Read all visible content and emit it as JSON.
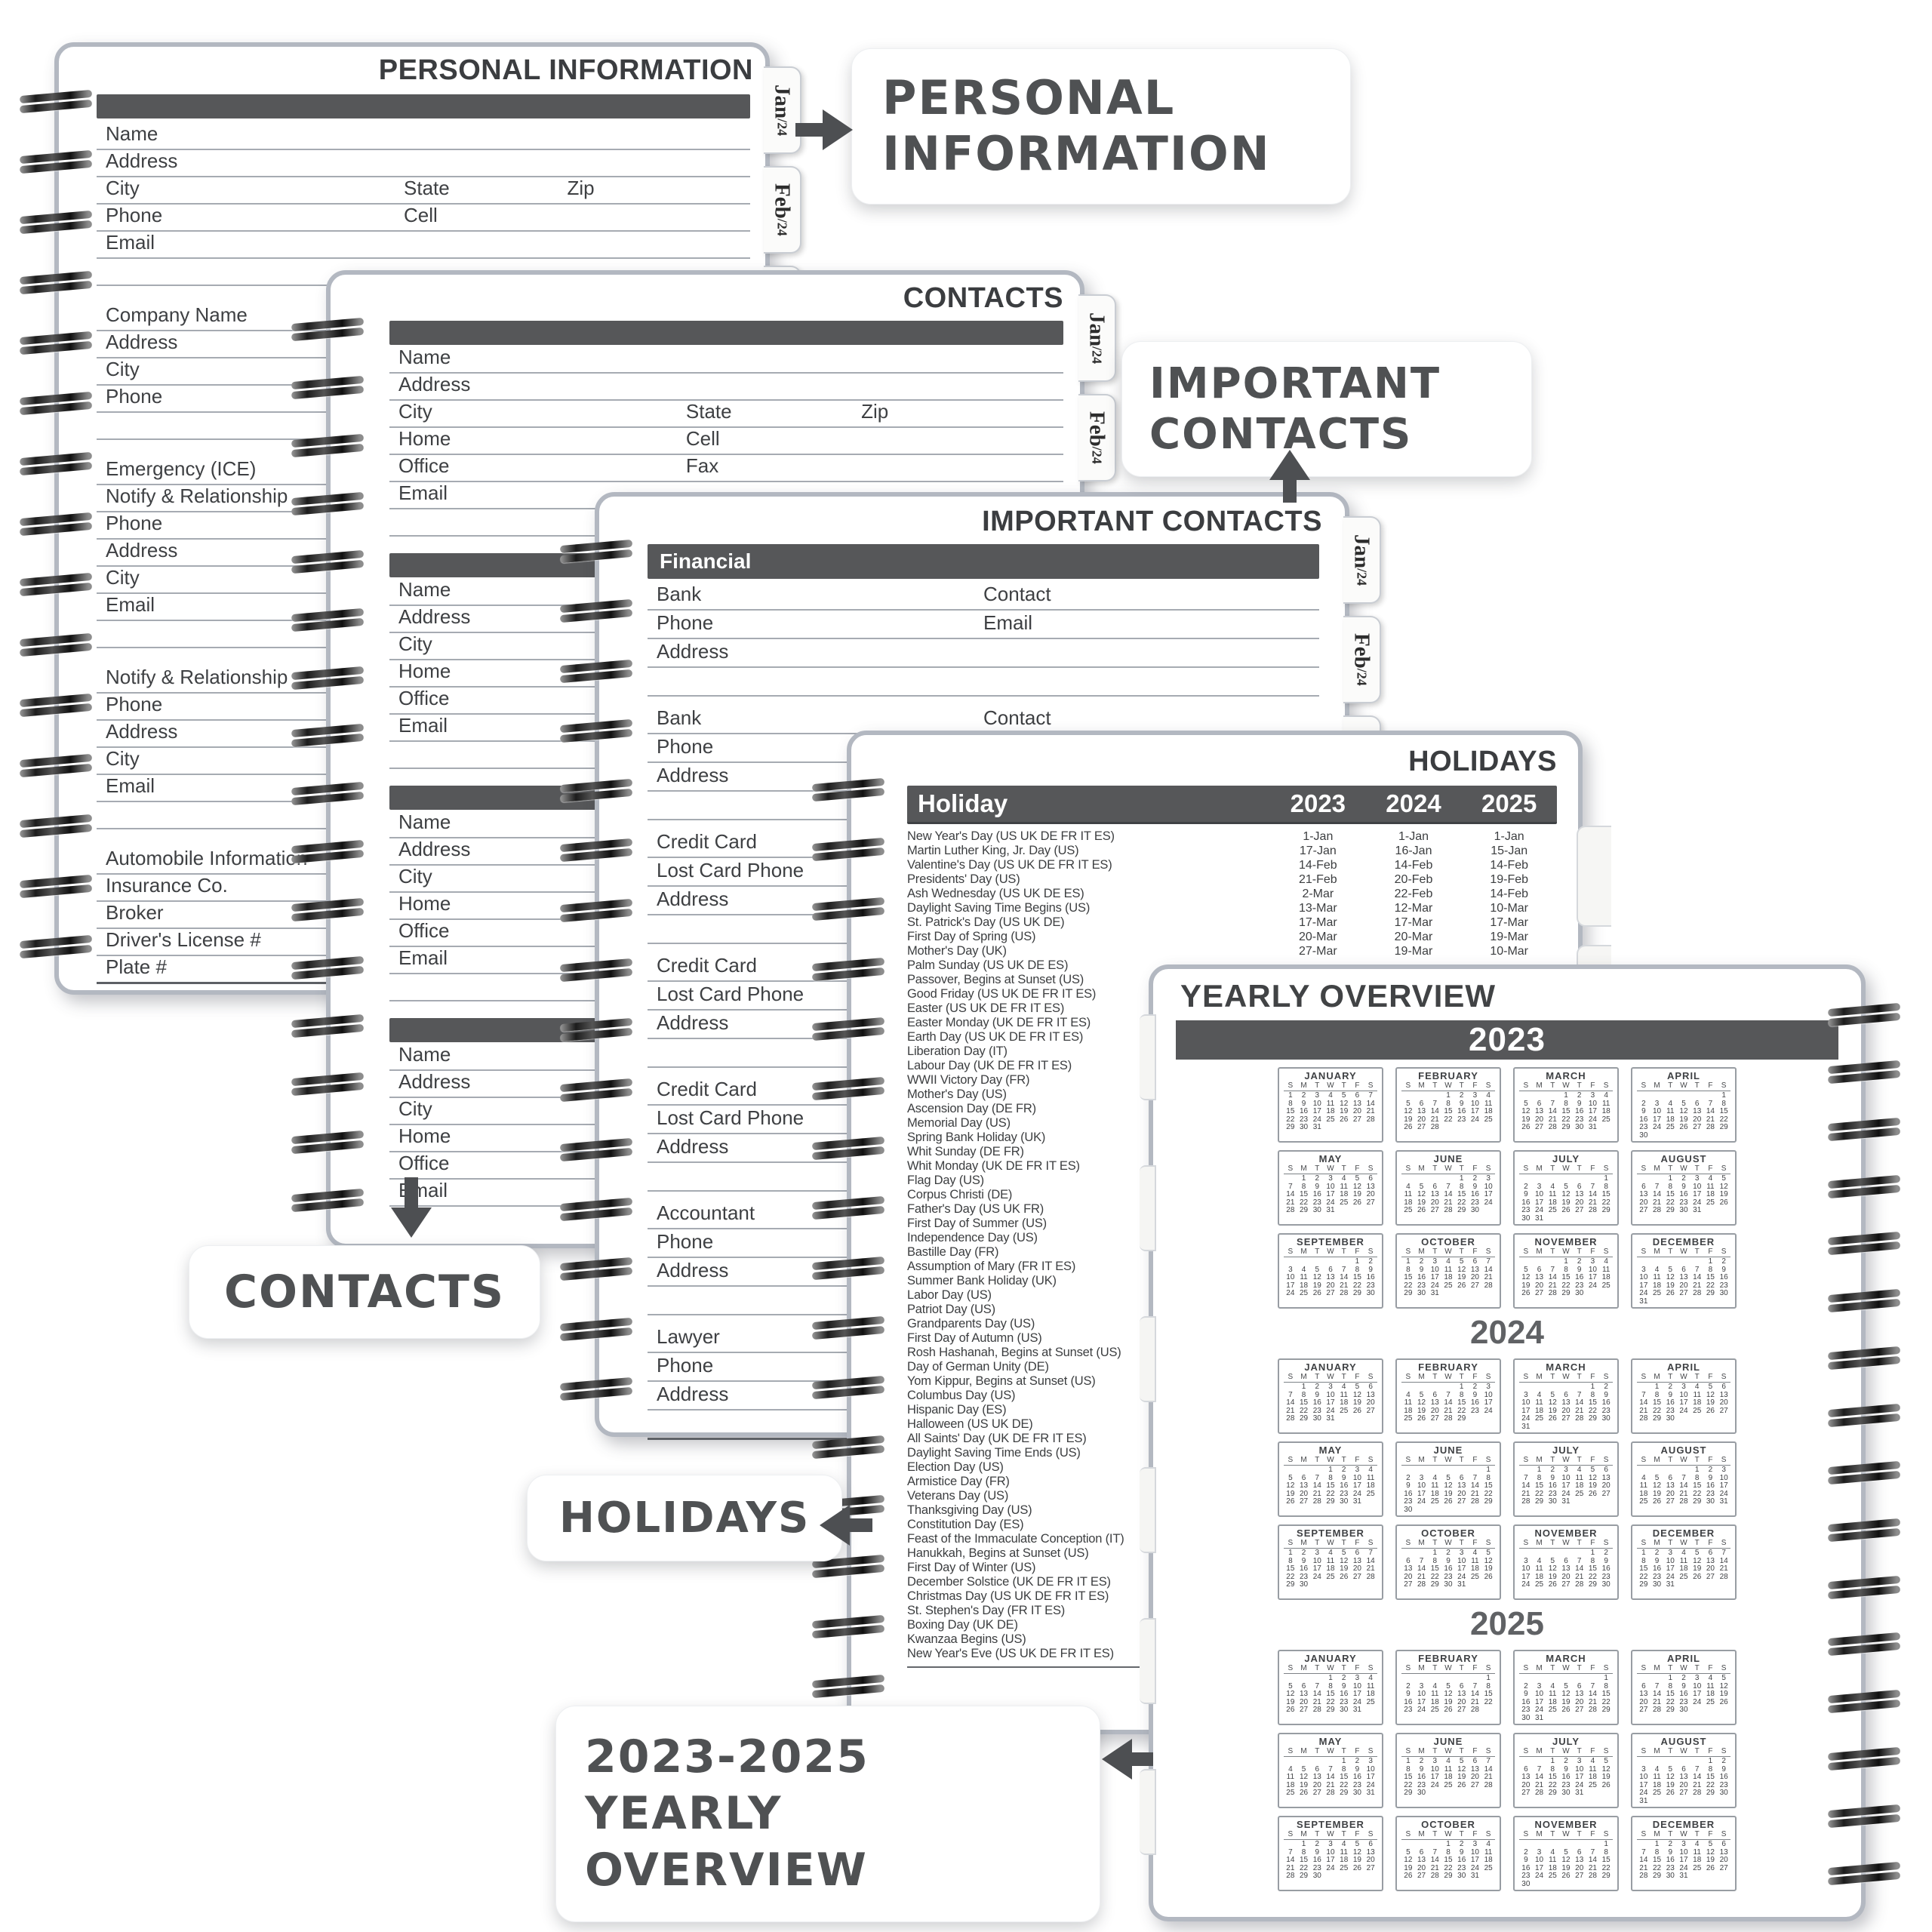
{
  "colors": {
    "bar": "#565759",
    "ink": "#3e4043",
    "line": "#a6abb2",
    "callout_text": "#4f5153",
    "arrow": "#4d4f52",
    "page_border": "#b3b8c1"
  },
  "callouts": {
    "personal": "PERSONAL INFORMATION",
    "important": "IMPORTANT CONTACTS",
    "contacts": "CONTACTS",
    "holidays": "HOLIDAYS",
    "yearly": "2023-2025 YEARLY OVERVIEW"
  },
  "tabs": {
    "items": [
      {
        "label": "Jan",
        "suffix": "/24"
      },
      {
        "label": "Feb",
        "suffix": "/24"
      },
      {
        "label": "Ma",
        "suffix": ""
      }
    ]
  },
  "pages": {
    "personal": {
      "title": "PERSONAL INFORMATION",
      "sections": [
        {
          "bar": true,
          "rows": [
            [
              "Name"
            ],
            [
              "Address"
            ],
            [
              "City",
              "State",
              "Zip"
            ],
            [
              "Phone",
              "Cell"
            ],
            [
              "Email"
            ],
            []
          ]
        },
        {
          "rows": [
            [
              "Company Name"
            ],
            [
              "Address"
            ],
            [
              "City"
            ],
            [
              "Phone"
            ],
            []
          ]
        },
        {
          "rows": [
            [
              "Emergency (ICE)"
            ],
            [
              "Notify & Relationship"
            ],
            [
              "Phone"
            ],
            [
              "Address"
            ],
            [
              "City"
            ],
            [
              "Email"
            ],
            []
          ]
        },
        {
          "rows": [
            [
              "Notify & Relationship"
            ],
            [
              "Phone"
            ],
            [
              "Address"
            ],
            [
              "City"
            ],
            [
              "Email"
            ],
            []
          ]
        },
        {
          "rows": [
            [
              "Automobile Information"
            ],
            [
              "Insurance Co."
            ],
            [
              "Broker"
            ],
            [
              "Driver's License #"
            ],
            [
              "Plate #"
            ]
          ]
        }
      ]
    },
    "contacts": {
      "title": "CONTACTS",
      "sections": [
        {
          "bar": true,
          "rows": [
            [
              "Name"
            ],
            [
              "Address"
            ],
            [
              "City",
              "State",
              "Zip"
            ],
            [
              "Home",
              "Cell"
            ],
            [
              "Office",
              "Fax"
            ],
            [
              "Email"
            ],
            []
          ]
        },
        {
          "bar": true,
          "rows": [
            [
              "Name"
            ],
            [
              "Address"
            ],
            [
              "City"
            ],
            [
              "Home"
            ],
            [
              "Office"
            ],
            [
              "Email"
            ],
            []
          ]
        },
        {
          "bar": true,
          "rows": [
            [
              "Name"
            ],
            [
              "Address"
            ],
            [
              "City"
            ],
            [
              "Home"
            ],
            [
              "Office"
            ],
            [
              "Email"
            ],
            []
          ]
        },
        {
          "bar": true,
          "rows": [
            [
              "Name"
            ],
            [
              "Address"
            ],
            [
              "City"
            ],
            [
              "Home"
            ],
            [
              "Office"
            ],
            [
              "Email"
            ]
          ]
        }
      ]
    },
    "important": {
      "title": "IMPORTANT CONTACTS",
      "sections": [
        {
          "bar": true,
          "bar_label": "Financial",
          "rows": [
            [
              "Bank",
              "Contact"
            ],
            [
              "Phone",
              "Email"
            ],
            [
              "Address"
            ],
            []
          ]
        },
        {
          "rows": [
            [
              "Bank",
              "Contact"
            ],
            [
              "Phone",
              "Email"
            ],
            [
              "Address"
            ],
            []
          ]
        },
        {
          "rows": [
            [
              "Credit Card"
            ],
            [
              "Lost Card Phone"
            ],
            [
              "Address"
            ],
            []
          ]
        },
        {
          "rows": [
            [
              "Credit Card"
            ],
            [
              "Lost Card Phone"
            ],
            [
              "Address"
            ],
            []
          ]
        },
        {
          "rows": [
            [
              "Credit Card"
            ],
            [
              "Lost Card Phone"
            ],
            [
              "Address"
            ],
            []
          ]
        },
        {
          "rows": [
            [
              "Accountant"
            ],
            [
              "Phone"
            ],
            [
              "Address"
            ],
            []
          ]
        },
        {
          "rows": [
            [
              "Lawyer"
            ],
            [
              "Phone"
            ],
            [
              "Address"
            ],
            []
          ]
        }
      ]
    },
    "holidays": {
      "title": "HOLIDAYS",
      "header": {
        "holiday": "Holiday",
        "years": [
          "2023",
          "2024",
          "2025"
        ]
      },
      "rows": [
        {
          "name": "New Year's Day (US UK DE FR IT ES)",
          "dates": [
            "1-Jan",
            "1-Jan",
            "1-Jan"
          ]
        },
        {
          "name": "Martin Luther King, Jr. Day (US)",
          "dates": [
            "17-Jan",
            "16-Jan",
            "15-Jan"
          ]
        },
        {
          "name": "Valentine's Day (US UK DE FR IT ES)",
          "dates": [
            "14-Feb",
            "14-Feb",
            "14-Feb"
          ]
        },
        {
          "name": "Presidents' Day (US)",
          "dates": [
            "21-Feb",
            "20-Feb",
            "19-Feb"
          ]
        },
        {
          "name": "Ash Wednesday (US UK DE ES)",
          "dates": [
            "2-Mar",
            "22-Feb",
            "14-Feb"
          ]
        },
        {
          "name": "Daylight Saving Time Begins (US)",
          "dates": [
            "13-Mar",
            "12-Mar",
            "10-Mar"
          ]
        },
        {
          "name": "St. Patrick's Day (US UK DE)",
          "dates": [
            "17-Mar",
            "17-Mar",
            "17-Mar"
          ]
        },
        {
          "name": "First Day of Spring (US)",
          "dates": [
            "20-Mar",
            "20-Mar",
            "19-Mar"
          ]
        },
        {
          "name": "Mother's Day (UK)",
          "dates": [
            "27-Mar",
            "19-Mar",
            "10-Mar"
          ]
        },
        {
          "name": "Palm Sunday (US UK DE ES)"
        },
        {
          "name": "Passover, Begins at Sunset (US)"
        },
        {
          "name": "Good Friday (US UK DE FR IT ES)"
        },
        {
          "name": "Easter (US UK DE FR IT ES)"
        },
        {
          "name": "Easter Monday (UK DE FR IT ES)"
        },
        {
          "name": "Earth Day (US UK DE FR IT ES)"
        },
        {
          "name": "Liberation Day (IT)"
        },
        {
          "name": "Labour Day (UK DE FR IT ES)"
        },
        {
          "name": "WWII Victory Day (FR)"
        },
        {
          "name": "Mother's Day (US)"
        },
        {
          "name": "Ascension Day (DE FR)"
        },
        {
          "name": "Memorial Day (US)"
        },
        {
          "name": "Spring Bank Holiday (UK)"
        },
        {
          "name": "Whit Sunday (DE FR)"
        },
        {
          "name": "Whit Monday (UK DE FR IT ES)"
        },
        {
          "name": "Flag Day (US)"
        },
        {
          "name": "Corpus Christi (DE)"
        },
        {
          "name": "Father's Day (US UK FR)"
        },
        {
          "name": "First Day of Summer (US)"
        },
        {
          "name": "Independence Day (US)"
        },
        {
          "name": "Bastille Day (FR)"
        },
        {
          "name": "Assumption of Mary (FR IT ES)"
        },
        {
          "name": "Summer Bank Holiday (UK)"
        },
        {
          "name": "Labor Day (US)"
        },
        {
          "name": "Patriot Day (US)"
        },
        {
          "name": "Grandparents Day (US)"
        },
        {
          "name": "First Day of Autumn (US)"
        },
        {
          "name": "Rosh Hashanah, Begins at Sunset (US)"
        },
        {
          "name": "Day of German Unity (DE)"
        },
        {
          "name": "Yom Kippur, Begins at Sunset (US)"
        },
        {
          "name": "Columbus Day (US)"
        },
        {
          "name": "Hispanic Day (ES)"
        },
        {
          "name": "Halloween (US UK DE)"
        },
        {
          "name": "All Saints' Day (UK DE FR IT ES)"
        },
        {
          "name": "Daylight Saving Time Ends (US)"
        },
        {
          "name": "Election Day (US)"
        },
        {
          "name": "Armistice Day (FR)"
        },
        {
          "name": "Veterans Day (US)"
        },
        {
          "name": "Thanksgiving Day (US)"
        },
        {
          "name": "Constitution Day (ES)"
        },
        {
          "name": "Feast of the Immaculate Conception (IT)"
        },
        {
          "name": "Hanukkah, Begins at Sunset (US)"
        },
        {
          "name": "First Day of Winter (US)"
        },
        {
          "name": "December Solstice (UK DE FR IT ES)"
        },
        {
          "name": "Christmas Day (US UK DE FR IT ES)"
        },
        {
          "name": "St. Stephen's Day (FR IT ES)"
        },
        {
          "name": "Boxing Day (UK DE)"
        },
        {
          "name": "Kwanzaa Begins (US)"
        },
        {
          "name": "New Year's Eve (US UK DE FR IT ES)"
        }
      ]
    },
    "yearly": {
      "title": "YEARLY OVERVIEW",
      "dow": [
        "S",
        "M",
        "T",
        "W",
        "T",
        "F",
        "S"
      ],
      "years": [
        {
          "year": "2023",
          "style": "bar",
          "months": [
            {
              "name": "JANUARY",
              "start": 0,
              "days": 31
            },
            {
              "name": "FEBRUARY",
              "start": 3,
              "days": 28
            },
            {
              "name": "MARCH",
              "start": 3,
              "days": 31
            },
            {
              "name": "APRIL",
              "start": 6,
              "days": 30
            },
            {
              "name": "MAY",
              "start": 1,
              "days": 31
            },
            {
              "name": "JUNE",
              "start": 4,
              "days": 30
            },
            {
              "name": "JULY",
              "start": 6,
              "days": 31
            },
            {
              "name": "AUGUST",
              "start": 2,
              "days": 31
            },
            {
              "name": "SEPTEMBER",
              "start": 5,
              "days": 30
            },
            {
              "name": "OCTOBER",
              "start": 0,
              "days": 31
            },
            {
              "name": "NOVEMBER",
              "start": 3,
              "days": 30
            },
            {
              "name": "DECEMBER",
              "start": 5,
              "days": 31
            }
          ]
        },
        {
          "year": "2024",
          "style": "plain",
          "months": [
            {
              "name": "JANUARY",
              "start": 1,
              "days": 31
            },
            {
              "name": "FEBRUARY",
              "start": 4,
              "days": 29
            },
            {
              "name": "MARCH",
              "start": 5,
              "days": 31
            },
            {
              "name": "APRIL",
              "start": 1,
              "days": 30
            },
            {
              "name": "MAY",
              "start": 3,
              "days": 31
            },
            {
              "name": "JUNE",
              "start": 6,
              "days": 30
            },
            {
              "name": "JULY",
              "start": 1,
              "days": 31
            },
            {
              "name": "AUGUST",
              "start": 4,
              "days": 31
            },
            {
              "name": "SEPTEMBER",
              "start": 0,
              "days": 30
            },
            {
              "name": "OCTOBER",
              "start": 2,
              "days": 31
            },
            {
              "name": "NOVEMBER",
              "start": 5,
              "days": 30
            },
            {
              "name": "DECEMBER",
              "start": 0,
              "days": 31
            }
          ]
        },
        {
          "year": "2025",
          "style": "plain",
          "months": [
            {
              "name": "JANUARY",
              "start": 3,
              "days": 31
            },
            {
              "name": "FEBRUARY",
              "start": 6,
              "days": 28
            },
            {
              "name": "MARCH",
              "start": 6,
              "days": 31
            },
            {
              "name": "APRIL",
              "start": 2,
              "days": 30
            },
            {
              "name": "MAY",
              "start": 4,
              "days": 31
            },
            {
              "name": "JUNE",
              "start": 0,
              "days": 30
            },
            {
              "name": "JULY",
              "start": 2,
              "days": 31
            },
            {
              "name": "AUGUST",
              "start": 5,
              "days": 31
            },
            {
              "name": "SEPTEMBER",
              "start": 1,
              "days": 30
            },
            {
              "name": "OCTOBER",
              "start": 3,
              "days": 31
            },
            {
              "name": "NOVEMBER",
              "start": 6,
              "days": 30
            },
            {
              "name": "DECEMBER",
              "start": 1,
              "days": 31
            }
          ]
        }
      ]
    }
  }
}
